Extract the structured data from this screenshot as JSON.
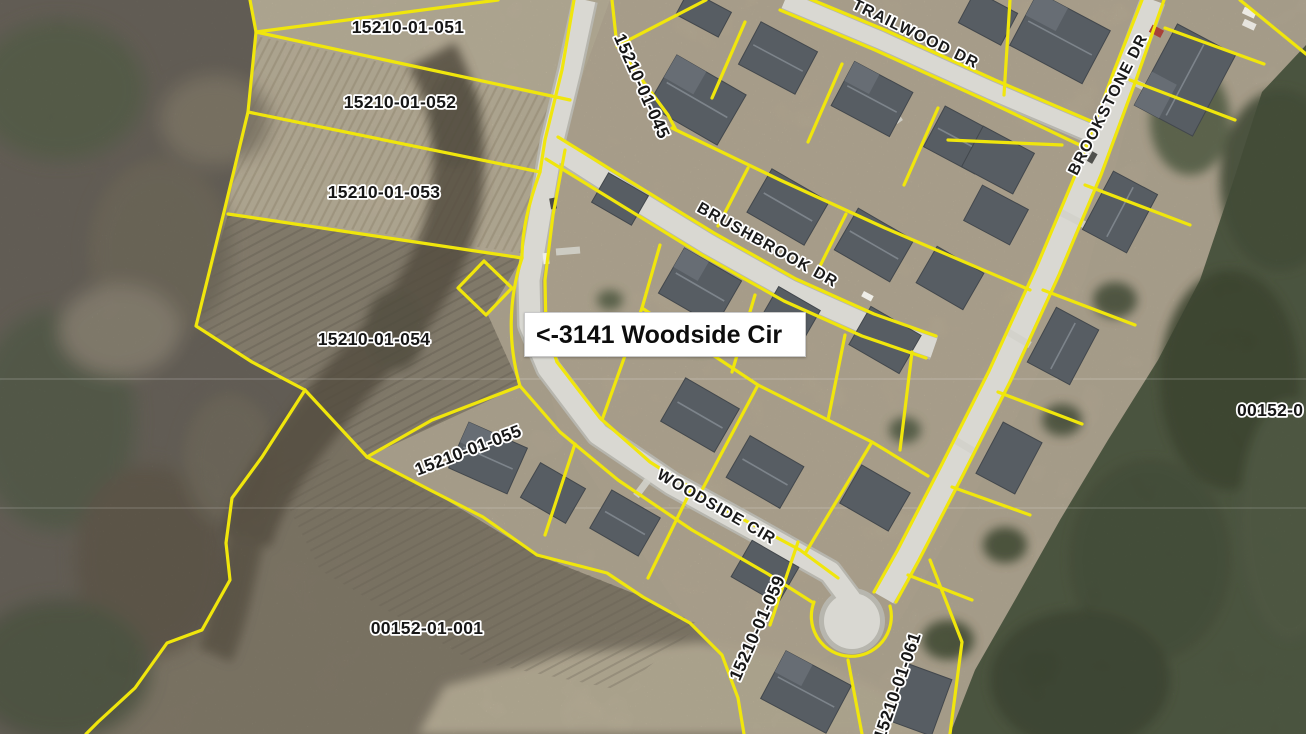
{
  "map": {
    "callout": {
      "text": "<-3141 Woodside Cir"
    },
    "streets": {
      "trailwood": "TRAILWOOD DR",
      "brushbrook": "BRUSHBROOK DR",
      "brookstone": "BROOKSTONE DR",
      "woodside": "WOODSIDE CIR"
    },
    "parcels": {
      "p051": "15210-01-051",
      "p052": "15210-01-052",
      "p053": "15210-01-053",
      "p054": "15210-01-054",
      "p055": "15210-01-055",
      "p045": "15210-01-045",
      "p059": "15210-01-059",
      "p061": "15210-01-061",
      "p001": "00152-01-001",
      "p00152_edge": "00152-0"
    },
    "colors": {
      "parcel_line": "#f0e60c",
      "road": "#d9d8d2",
      "road_edge": "#b7b6ae",
      "label_text": "#161616",
      "label_halo": "#ffffff",
      "callout_bg": "#ffffff",
      "callout_text": "#0d0d0d"
    }
  }
}
